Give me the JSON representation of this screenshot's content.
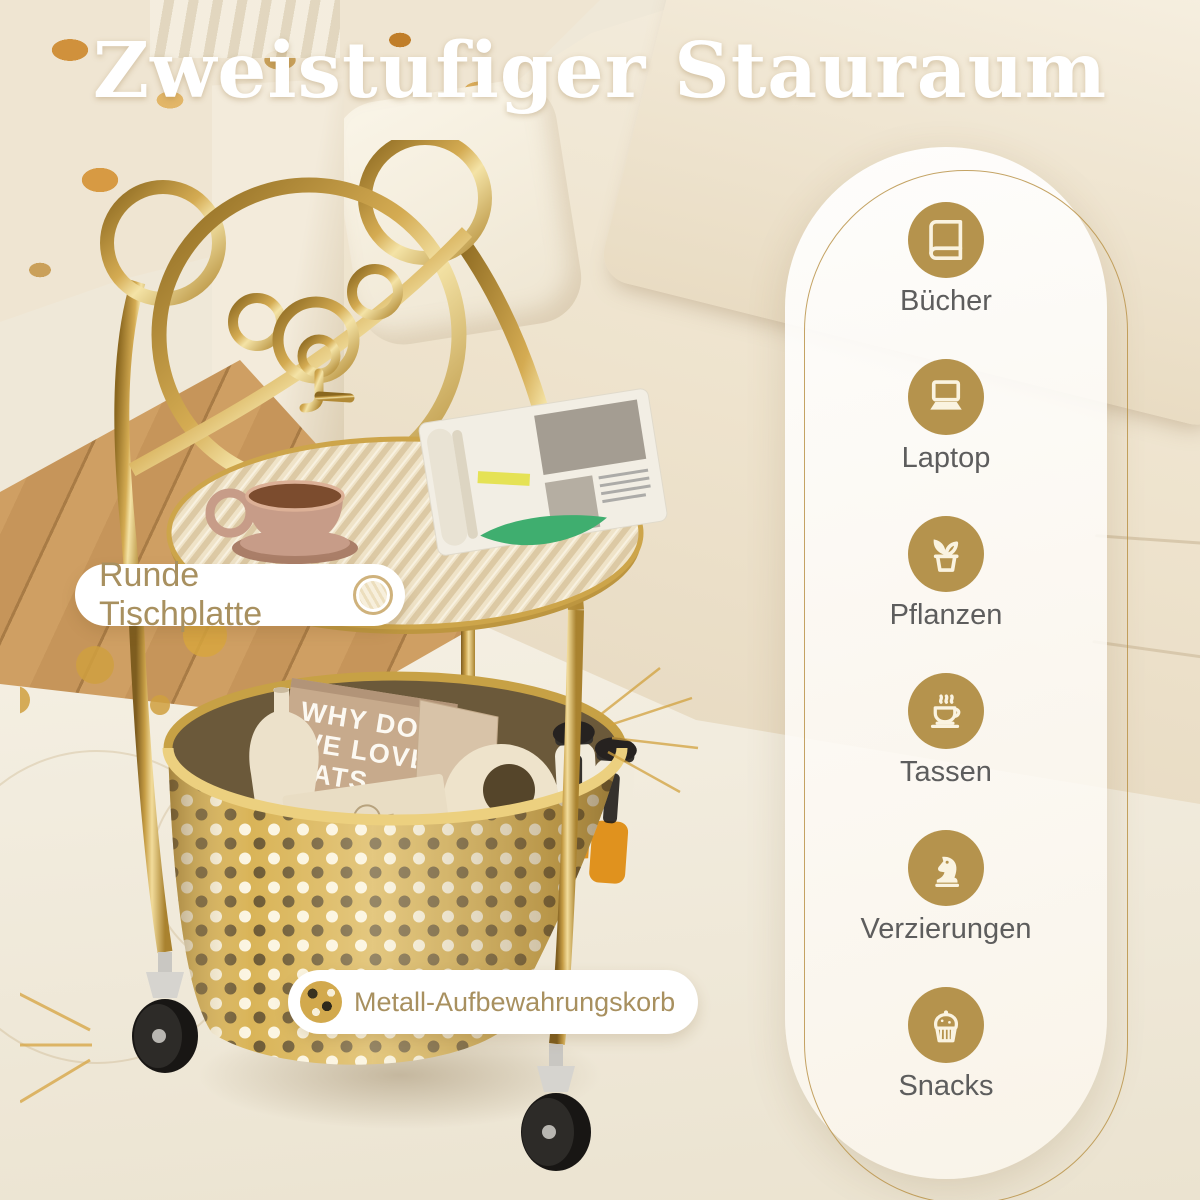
{
  "title": "Zweistufiger Stauraum",
  "callouts": {
    "tabletop": "Runde Tischplatte",
    "basket": "Metall-Aufbewahrungskorb"
  },
  "features": [
    {
      "icon": "book-icon",
      "label": "Bücher"
    },
    {
      "icon": "laptop-icon",
      "label": "Laptop"
    },
    {
      "icon": "plant-icon",
      "label": "Pflanzen"
    },
    {
      "icon": "coffee-cup-icon",
      "label": "Tassen"
    },
    {
      "icon": "chess-knight-icon",
      "label": "Verzierungen"
    },
    {
      "icon": "cupcake-icon",
      "label": "Snacks"
    }
  ],
  "cart": {
    "book_lines": [
      "WHY DO",
      "WE LOVE",
      "CATS"
    ],
    "card_brand": "BLANCHARD'S"
  },
  "colors": {
    "accent_gold": "#b5934d",
    "gold_outline": "#bf9a4f",
    "callout_text": "#a8905f",
    "feature_label": "#5d5d5d",
    "title_text": "#ffffff"
  }
}
